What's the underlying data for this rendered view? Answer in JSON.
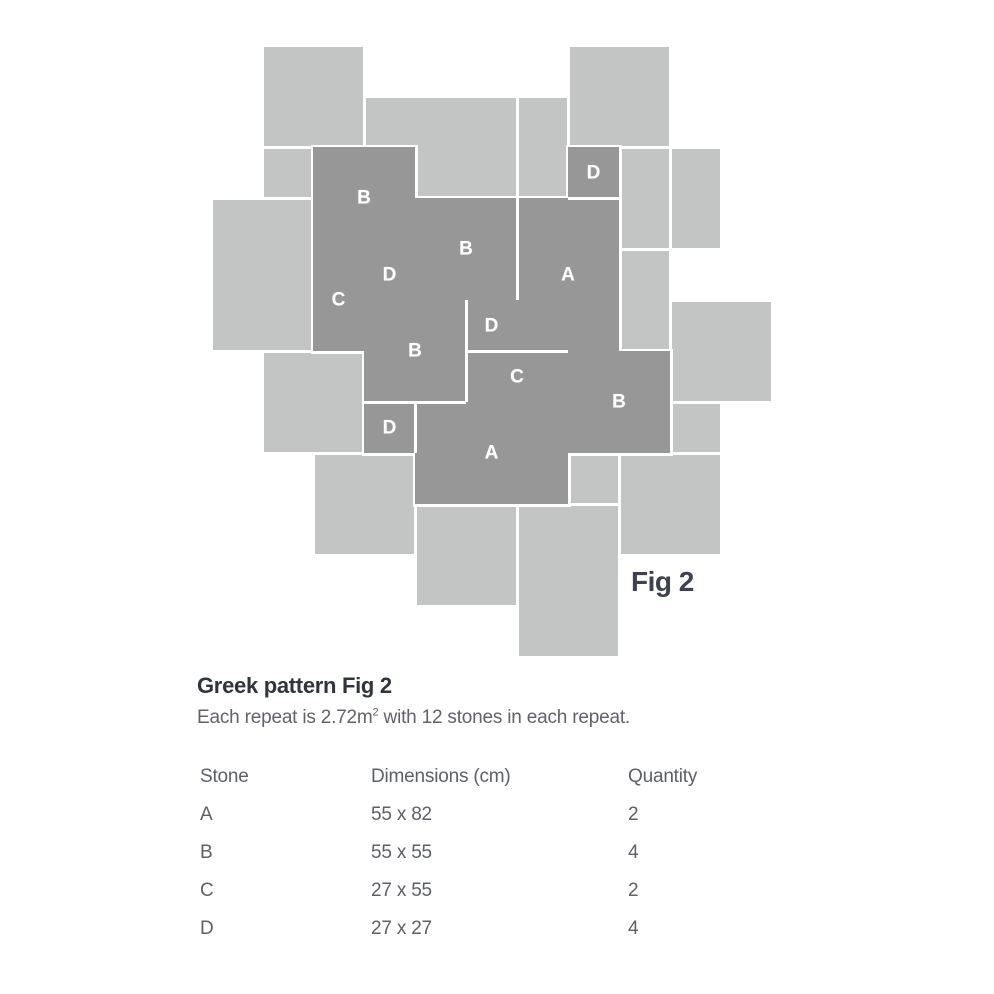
{
  "figure": {
    "fig_label": "Fig 2",
    "fig_label_pos": {
      "x": 631,
      "y": 566
    },
    "colors": {
      "light_tile": "#c3c4c4",
      "dark_tile": "#979797",
      "joint": "#ffffff",
      "stone_label": "#ffffff"
    },
    "light_tiles": [
      {
        "x": 262,
        "y": 45,
        "w": 102,
        "h": 102
      },
      {
        "x": 364,
        "y": 96,
        "w": 153,
        "h": 102
      },
      {
        "x": 517,
        "y": 96,
        "w": 51,
        "h": 102
      },
      {
        "x": 568,
        "y": 45,
        "w": 102,
        "h": 102
      },
      {
        "x": 262,
        "y": 147,
        "w": 51,
        "h": 51
      },
      {
        "x": 619,
        "y": 147,
        "w": 51,
        "h": 102
      },
      {
        "x": 670,
        "y": 147,
        "w": 51,
        "h": 102
      },
      {
        "x": 619,
        "y": 249,
        "w": 51,
        "h": 102
      },
      {
        "x": 670,
        "y": 300,
        "w": 102,
        "h": 102
      },
      {
        "x": 670,
        "y": 402,
        "w": 51,
        "h": 51
      },
      {
        "x": 211,
        "y": 198,
        "w": 102,
        "h": 153
      },
      {
        "x": 262,
        "y": 351,
        "w": 102,
        "h": 102
      },
      {
        "x": 313,
        "y": 453,
        "w": 102,
        "h": 102
      },
      {
        "x": 415,
        "y": 504,
        "w": 102,
        "h": 102
      },
      {
        "x": 568,
        "y": 453,
        "w": 51,
        "h": 51
      },
      {
        "x": 517,
        "y": 504,
        "w": 102,
        "h": 153
      },
      {
        "x": 619,
        "y": 453,
        "w": 102,
        "h": 102
      }
    ],
    "stones": [
      {
        "label": "B",
        "x": 313,
        "y": 147,
        "w": 102,
        "h": 102
      },
      {
        "label": "D",
        "x": 568,
        "y": 147,
        "w": 51,
        "h": 51
      },
      {
        "label": "B",
        "x": 415,
        "y": 198,
        "w": 102,
        "h": 102
      },
      {
        "label": "A",
        "x": 517,
        "y": 198,
        "w": 102,
        "h": 153
      },
      {
        "label": "D",
        "x": 364,
        "y": 249,
        "w": 51,
        "h": 51
      },
      {
        "label": "C",
        "x": 313,
        "y": 249,
        "w": 51,
        "h": 102
      },
      {
        "label": "D",
        "x": 466,
        "y": 300,
        "w": 51,
        "h": 51
      },
      {
        "label": "B",
        "x": 364,
        "y": 300,
        "w": 102,
        "h": 102
      },
      {
        "label": "C",
        "x": 466,
        "y": 351,
        "w": 102,
        "h": 51
      },
      {
        "label": "B",
        "x": 568,
        "y": 351,
        "w": 102,
        "h": 102
      },
      {
        "label": "D",
        "x": 364,
        "y": 402,
        "w": 51,
        "h": 51
      },
      {
        "label": "A",
        "x": 415,
        "y": 402,
        "w": 153,
        "h": 102
      }
    ],
    "joints": [
      {
        "x": 515.5,
        "y": 198,
        "w": 3,
        "h": 102
      },
      {
        "x": 464.5,
        "y": 300,
        "w": 3,
        "h": 102
      },
      {
        "x": 466,
        "y": 349.5,
        "w": 102,
        "h": 3
      },
      {
        "x": 364,
        "y": 400.5,
        "w": 102,
        "h": 3
      },
      {
        "x": 413.5,
        "y": 402,
        "w": 3,
        "h": 51
      },
      {
        "x": 568,
        "y": 196.5,
        "w": 51,
        "h": 3
      }
    ]
  },
  "heading": {
    "title": "Greek pattern Fig 2"
  },
  "description": {
    "prefix": "Each repeat is 2.72m",
    "superscript": "2",
    "suffix": " with 12 stones in each repeat."
  },
  "table": {
    "headers": [
      "Stone",
      "Dimensions (cm)",
      "Quantity"
    ],
    "rows": [
      {
        "stone": "A",
        "dimensions": "55 x 82",
        "quantity": "2"
      },
      {
        "stone": "B",
        "dimensions": "55 x 55",
        "quantity": "4"
      },
      {
        "stone": "C",
        "dimensions": "27 x 55",
        "quantity": "2"
      },
      {
        "stone": "D",
        "dimensions": "27 x 27",
        "quantity": "4"
      }
    ]
  }
}
